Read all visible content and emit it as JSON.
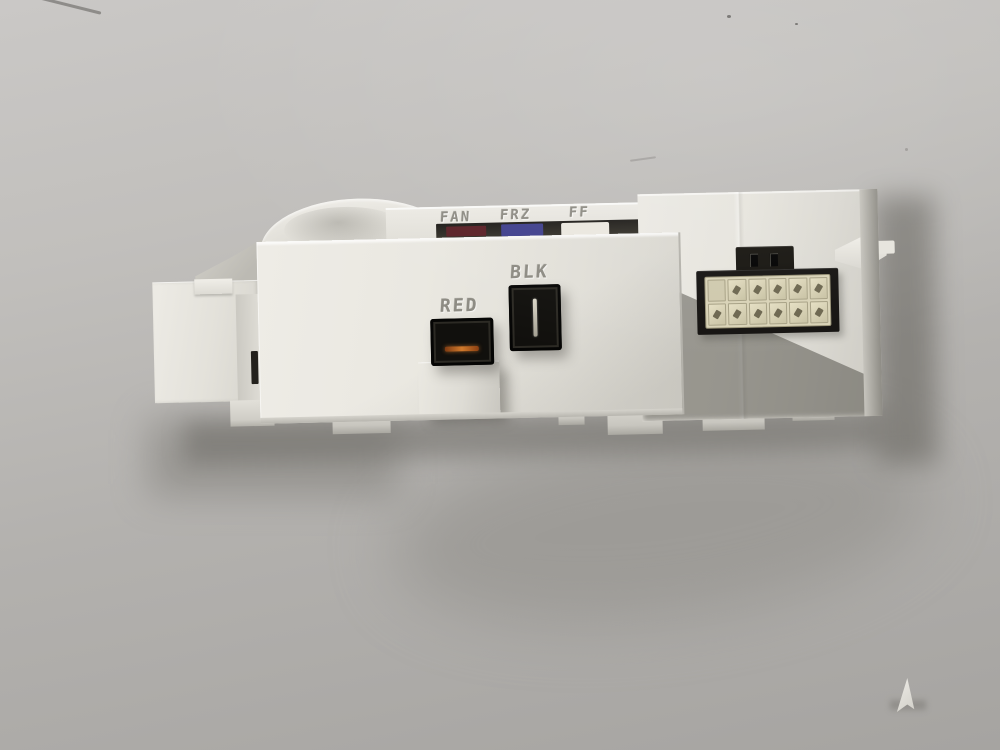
{
  "photo": {
    "subject": "White appliance control board module on gray backdrop",
    "backdrop_color": "#b3b1ae"
  },
  "module": {
    "plastic_color": "#e9e7e0",
    "top_edge_connectors": {
      "items": [
        {
          "label": "FAN",
          "color": "#5a2026"
        },
        {
          "label": "FRZ",
          "color": "#3f3f8c"
        },
        {
          "label": "FF",
          "color": "#eae7df"
        }
      ]
    },
    "front_sockets": {
      "red": {
        "label": "RED",
        "terminal_color": "#cf7a2c"
      },
      "blk": {
        "label": "BLK",
        "terminal_color": "#c5c1b3"
      }
    },
    "multipin_connector": {
      "rows": 2,
      "cols": 6,
      "pin_color": "#d9d3b7",
      "housing_color": "#151311"
    }
  }
}
